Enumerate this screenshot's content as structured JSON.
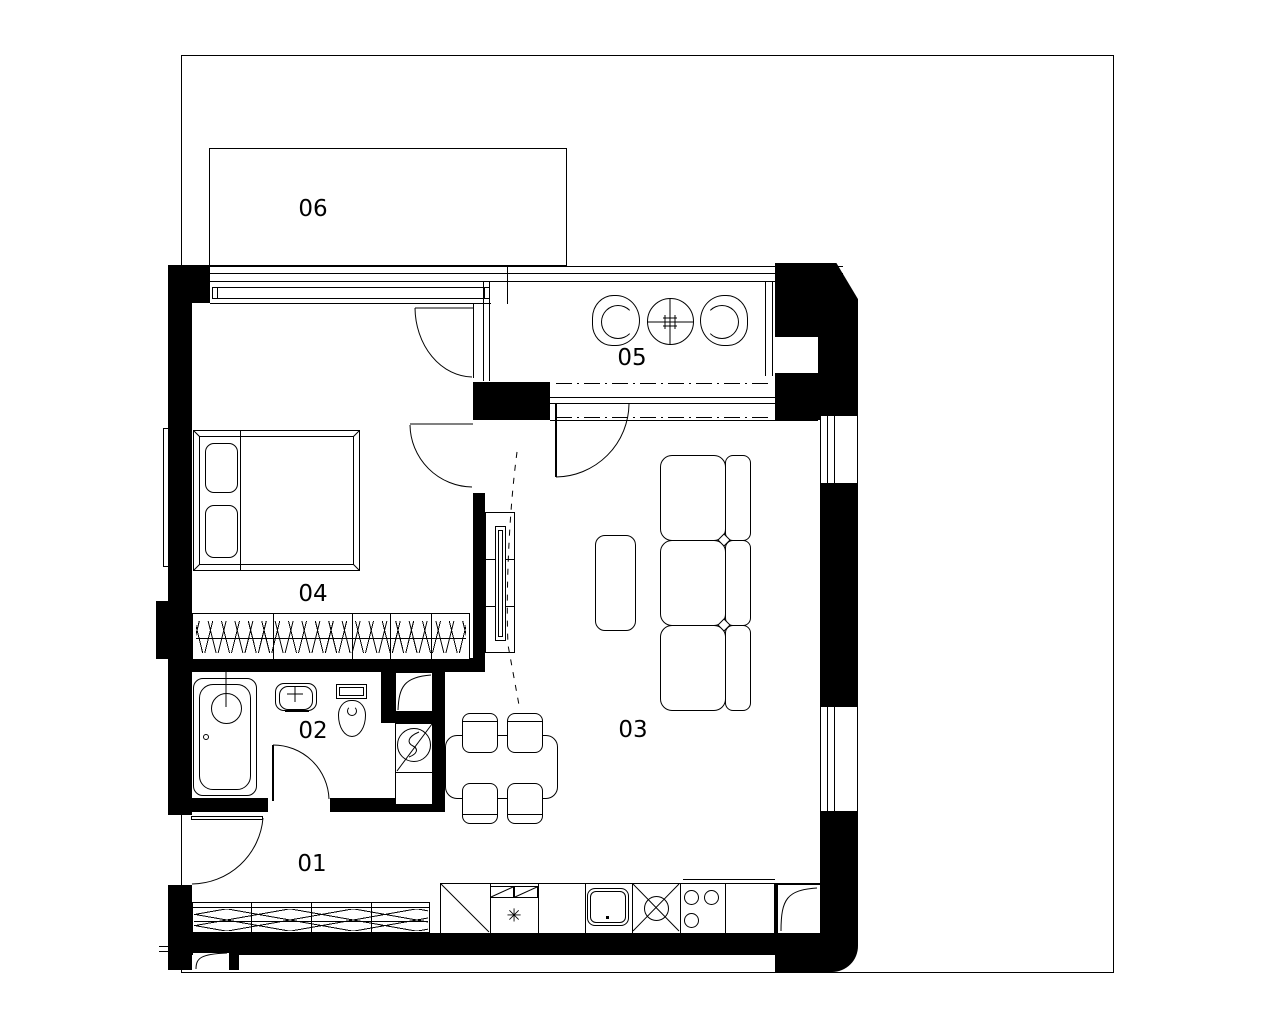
{
  "colors": {
    "line": "#000000",
    "background": "#ffffff"
  },
  "rooms": [
    {
      "label": "01"
    },
    {
      "label": "02"
    },
    {
      "label": "03"
    },
    {
      "label": "04"
    },
    {
      "label": "05"
    },
    {
      "label": "06"
    }
  ],
  "kitchen": {
    "appliance_symbol": "✳"
  }
}
